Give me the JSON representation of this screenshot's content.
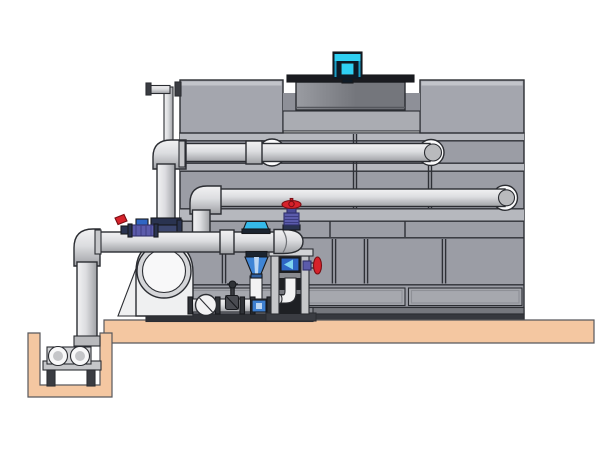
{
  "title": "Cooling tower and pump skid piping illustration",
  "scene": {
    "width": 600,
    "height": 450,
    "text_visible": false
  },
  "colors": {
    "background": "#ffffff",
    "tower_body": "#9b9da5",
    "tower_panel_light": "#b6b8be",
    "tower_panel_mid": "#a6a8ae",
    "tower_top_box": "#a4a6ae",
    "tower_top_box_highlight": "#c2c4ca",
    "tower_recess": "#8e9098",
    "tower_recess_panel": "#aaacb2",
    "tower_base_upper": "#75777d",
    "tower_base_lower": "#36383e",
    "cowl_rim": "#1a1b20",
    "cowl_body_light": "#9a9ca2",
    "cowl_body_dark": "#74767c",
    "motor_body": "#0e1a26",
    "motor_cyan": "#2fd0f2",
    "motor_cyan_dark": "#1b9ec4",
    "pipe_light": "#f2f2f3",
    "pipe_mid": "#dcdde0",
    "pipe_shadow": "#9fa1a5",
    "flange_ring": "#fbfbfc",
    "pipe_cap": "#b9babd",
    "concrete": "#f4c7a1",
    "steel_light": "#d2d3d6",
    "steel_mid": "#c5c6c9",
    "steel_dark": "#3a3c42",
    "frame_interior": "#1e2024",
    "pump_body": "#eff0f1",
    "pump_ring": "#d5d6d9",
    "pump_ring_inner": "#f8f8f9",
    "valve_red": "#d6222b",
    "valve_purple": "#5b5bab",
    "valve_purple_deep": "#4a4a96",
    "valve_navy": "#2a3350",
    "valve_navy_light": "#3c466e",
    "device_blue": "#3f85d6",
    "device_blue_dark": "#2f5fa0",
    "device_cyan": "#35b9e9",
    "device_band": "#1b2430",
    "fitting_blue": "#2f66c4",
    "fitting_arrow": "#7fd4f0",
    "manifold_blue": "#3d7fd0",
    "manifold_blue_center": "#bcd6f2",
    "dark_metal": "#2f3237",
    "skid_deck": "#888a90",
    "skid_base": "#2f3136",
    "gate_valve_body": "#4a4c52"
  },
  "components": [
    {
      "name": "fan-motor",
      "label": "Fan drive motor (cyan)"
    },
    {
      "name": "fan-cowl",
      "label": "Fan discharge cowl"
    },
    {
      "name": "cooling-tower",
      "label": "Cooling tower casing with panels"
    },
    {
      "name": "vent-pipe",
      "label": "Small overflow vent pipe"
    },
    {
      "name": "upper-return-pipe",
      "label": "Upper flanged return pipe"
    },
    {
      "name": "lower-return-pipe",
      "label": "Lower flanged return pipe"
    },
    {
      "name": "suction-pipe",
      "label": "Main suction pipe to sump"
    },
    {
      "name": "centrifugal-pump",
      "label": "Centrifugal pump with round inlet"
    },
    {
      "name": "inline-pump",
      "label": "Inline pump / control device (blue)"
    },
    {
      "name": "globe-valve-top",
      "label": "Globe valve with red handwheel"
    },
    {
      "name": "side-globe-valve",
      "label": "Side globe valve with red handwheel"
    },
    {
      "name": "ball-valve",
      "label": "Small ball valve with red lever"
    },
    {
      "name": "control-valve",
      "label": "Purple control valve"
    },
    {
      "name": "check-valve",
      "label": "Sight glass / check valve"
    },
    {
      "name": "gate-valve",
      "label": "Small gate valve"
    },
    {
      "name": "drain-manifold",
      "label": "Drain manifold with flanges"
    },
    {
      "name": "support-frame",
      "label": "Steel pipe support frame"
    },
    {
      "name": "concrete-slab",
      "label": "Concrete foundation slab"
    },
    {
      "name": "sump-pit",
      "label": "Concrete sump pit"
    },
    {
      "name": "sump-pump",
      "label": "Sump pump on stand"
    }
  ]
}
